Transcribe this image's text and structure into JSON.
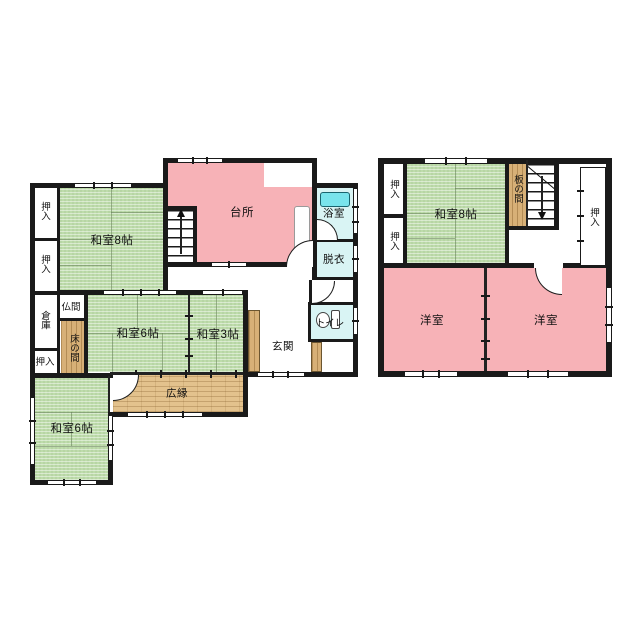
{
  "plan_title": "2-story house floor plan",
  "colors": {
    "tatami_green": "#bedcab",
    "room_pink": "#f7b2b7",
    "wet_area_cyan": "#d9f4f4",
    "bathtub_cyan": "#79e4ec",
    "wood_floor": "#d7b077",
    "veranda_wood": "#e3c28d",
    "wall_black": "#1a1a1a"
  },
  "f1": {
    "kitchen": "台所",
    "bath": "浴室",
    "dressing": "脱衣",
    "toilet": "トイレ",
    "entrance": "玄関",
    "washitsu8": "和室8帖",
    "washitsu6_center": "和室6帖",
    "washitsu3": "和室3帖",
    "washitsu6_south": "和室6帖",
    "veranda": "広縁",
    "butsuma": "仏間",
    "tokonoma": "床の間",
    "storage": "倉庫",
    "closet": "押入"
  },
  "f2": {
    "washitsu8": "和室8帖",
    "itanoma": "板の間",
    "closet": "押入",
    "western": "洋室"
  }
}
